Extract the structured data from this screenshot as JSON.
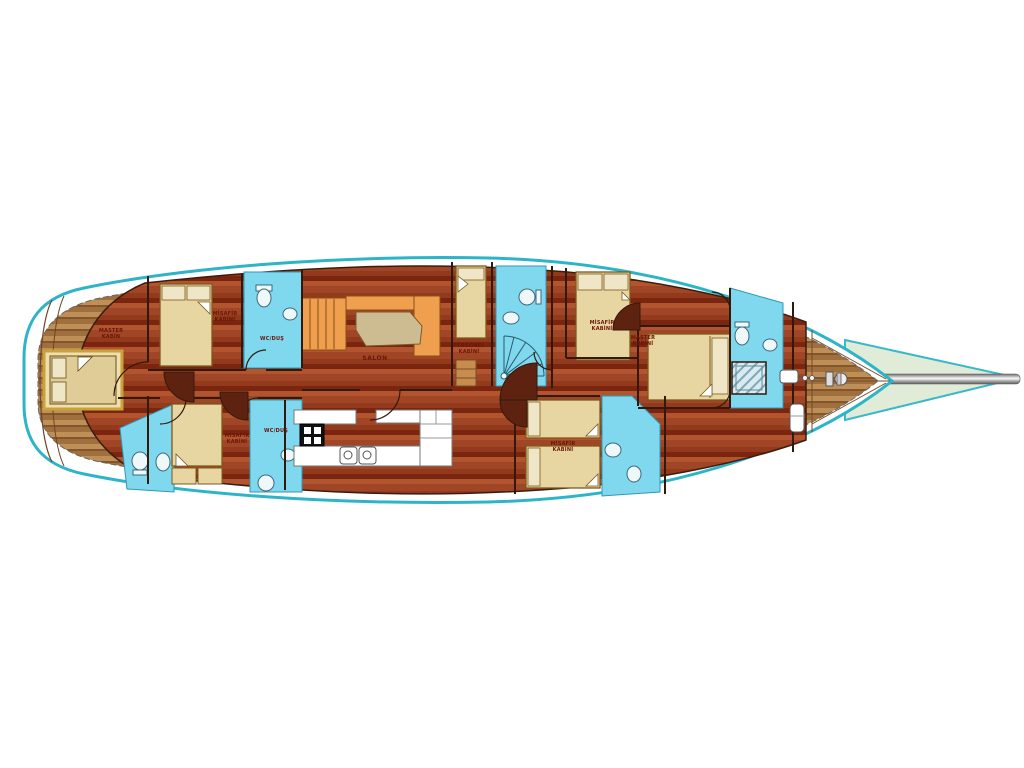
{
  "plan": {
    "description": "yacht interior deck plan",
    "labels": {
      "master_aft_l1": "MASTER",
      "master_aft_l2": "KABİN",
      "guest_top_aft_l1": "MİSAFİR",
      "guest_top_aft_l2": "KABİNİ",
      "wc_top": "WC/DUŞ",
      "guest_bottom_aft_l1": "MİSAFİR",
      "guest_bottom_aft_l2": "KABİNİ",
      "wc_bottom": "WC/DUŞ",
      "salon": "SALON",
      "crew_l1": "PERSONEL",
      "crew_l2": "KABİNİ",
      "guest_top_fore_l1": "MİSAFİR",
      "guest_top_fore_l2": "KABİNİ",
      "master_fore_l1": "MASTER",
      "master_fore_l2": "KABİNİ",
      "guest_twin_l1": "MİSAFİR",
      "guest_twin_l2": "KABİNİ"
    },
    "colors": {
      "hull_outline": "#2db4c9",
      "cabin_floor": "#93391c",
      "deck_wood": "#b08049",
      "bathroom": "#7fd8ee",
      "bed": "#e7d5a2",
      "sofa": "#ef9f4e",
      "table": "#cdbb92",
      "net": "#e0ecd8",
      "label_text": "#6b1608"
    }
  }
}
